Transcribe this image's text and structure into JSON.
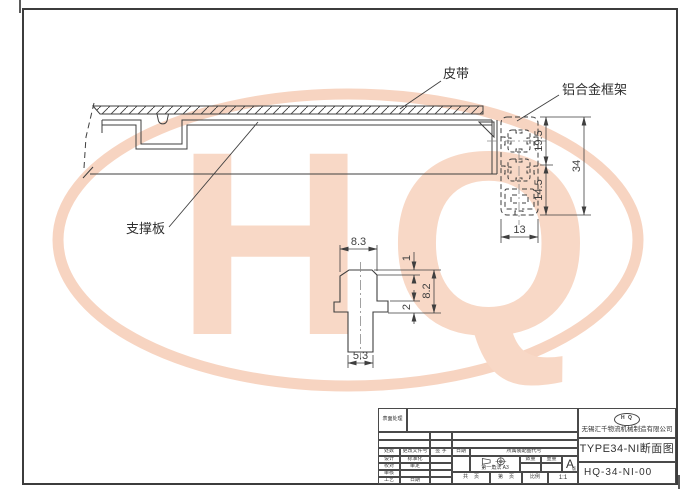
{
  "watermark": {
    "text": "HQ",
    "color": "#f8d7c5"
  },
  "drawing": {
    "labels": {
      "belt": "皮带",
      "frame": "铝合金框架",
      "support": "支撑板"
    },
    "dimensions": {
      "profile": {
        "upper": "19.5",
        "lower": "14.5",
        "total": "34",
        "width": "13"
      },
      "detail": {
        "top_width": "8.3",
        "lip": "1",
        "height": "8.2",
        "flange": "2",
        "bottom_width": "5.3"
      }
    }
  },
  "title_block": {
    "surface_label": "表面处理",
    "revision_headers": [
      "处数",
      "更改文件号",
      "签 字",
      "日期"
    ],
    "approval_rows": [
      {
        "left": "设计",
        "right": "标准化"
      },
      {
        "left": "校对",
        "right": "审定"
      },
      {
        "left": "审核",
        "right": ""
      },
      {
        "left": "工艺",
        "right": "日期"
      }
    ],
    "assembly_label": "所属装配图代号",
    "projection_label": "第一角法",
    "paper_size": "A3",
    "qty_label": "数量",
    "weight_label": "重量",
    "version_letter": "A",
    "version_label": "版",
    "sheet_labels": {
      "total": "共",
      "page1": "页",
      "no": "第",
      "page2": "页",
      "scale_label": "比例",
      "scale_value": "1:1"
    },
    "logo_text": "H Q",
    "company": "无锡汇千物流机械制造有限公司",
    "drawing_title": "TYPE34-NI断面图",
    "drawing_number": "HQ-34-NI-00"
  }
}
